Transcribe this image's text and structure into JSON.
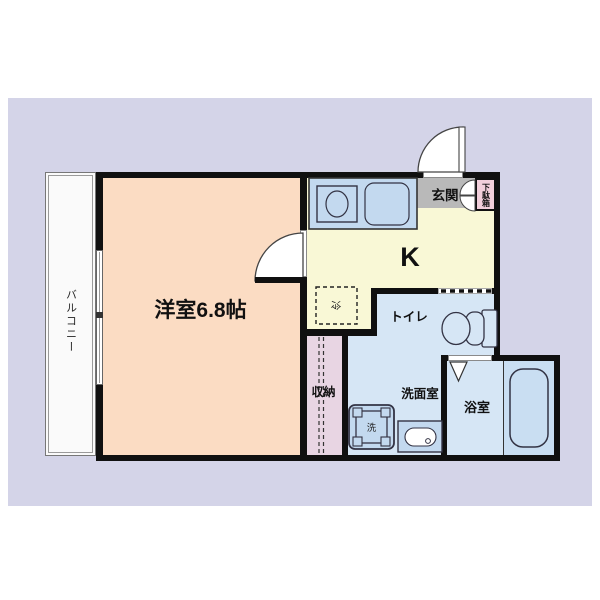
{
  "plan": {
    "type": "apartment-floor-plan-1K",
    "rooms": {
      "balcony": {
        "label": "バルコニー",
        "color": "#fafafa"
      },
      "western_room": {
        "label": "洋室6.8帖",
        "color": "#fbdcc3"
      },
      "kitchen": {
        "label": "K",
        "color": "#f9f8d6"
      },
      "entrance": {
        "label": "玄関",
        "color": "#b9b9b9"
      },
      "shoe_cabinet": {
        "label": "下駄箱",
        "color": "#f2cfdb"
      },
      "refrigerator_space": {
        "label": "冷"
      },
      "toilet": {
        "label": "トイレ",
        "color": "#d6e6f5"
      },
      "washroom": {
        "label": "洗面室",
        "color": "#d6e6f5"
      },
      "washer_space": {
        "label": "洗"
      },
      "storage": {
        "label": "収納",
        "color": "#e8d5e3"
      },
      "bathroom": {
        "label": "浴室",
        "color": "#d6e6f5"
      }
    },
    "colors": {
      "page_background": "#ffffff",
      "panel_background": "#d4d4e8",
      "wall": "#101010",
      "fixture_fill": "#c3d9ef",
      "bathtub_panel": "#c9def2"
    }
  }
}
